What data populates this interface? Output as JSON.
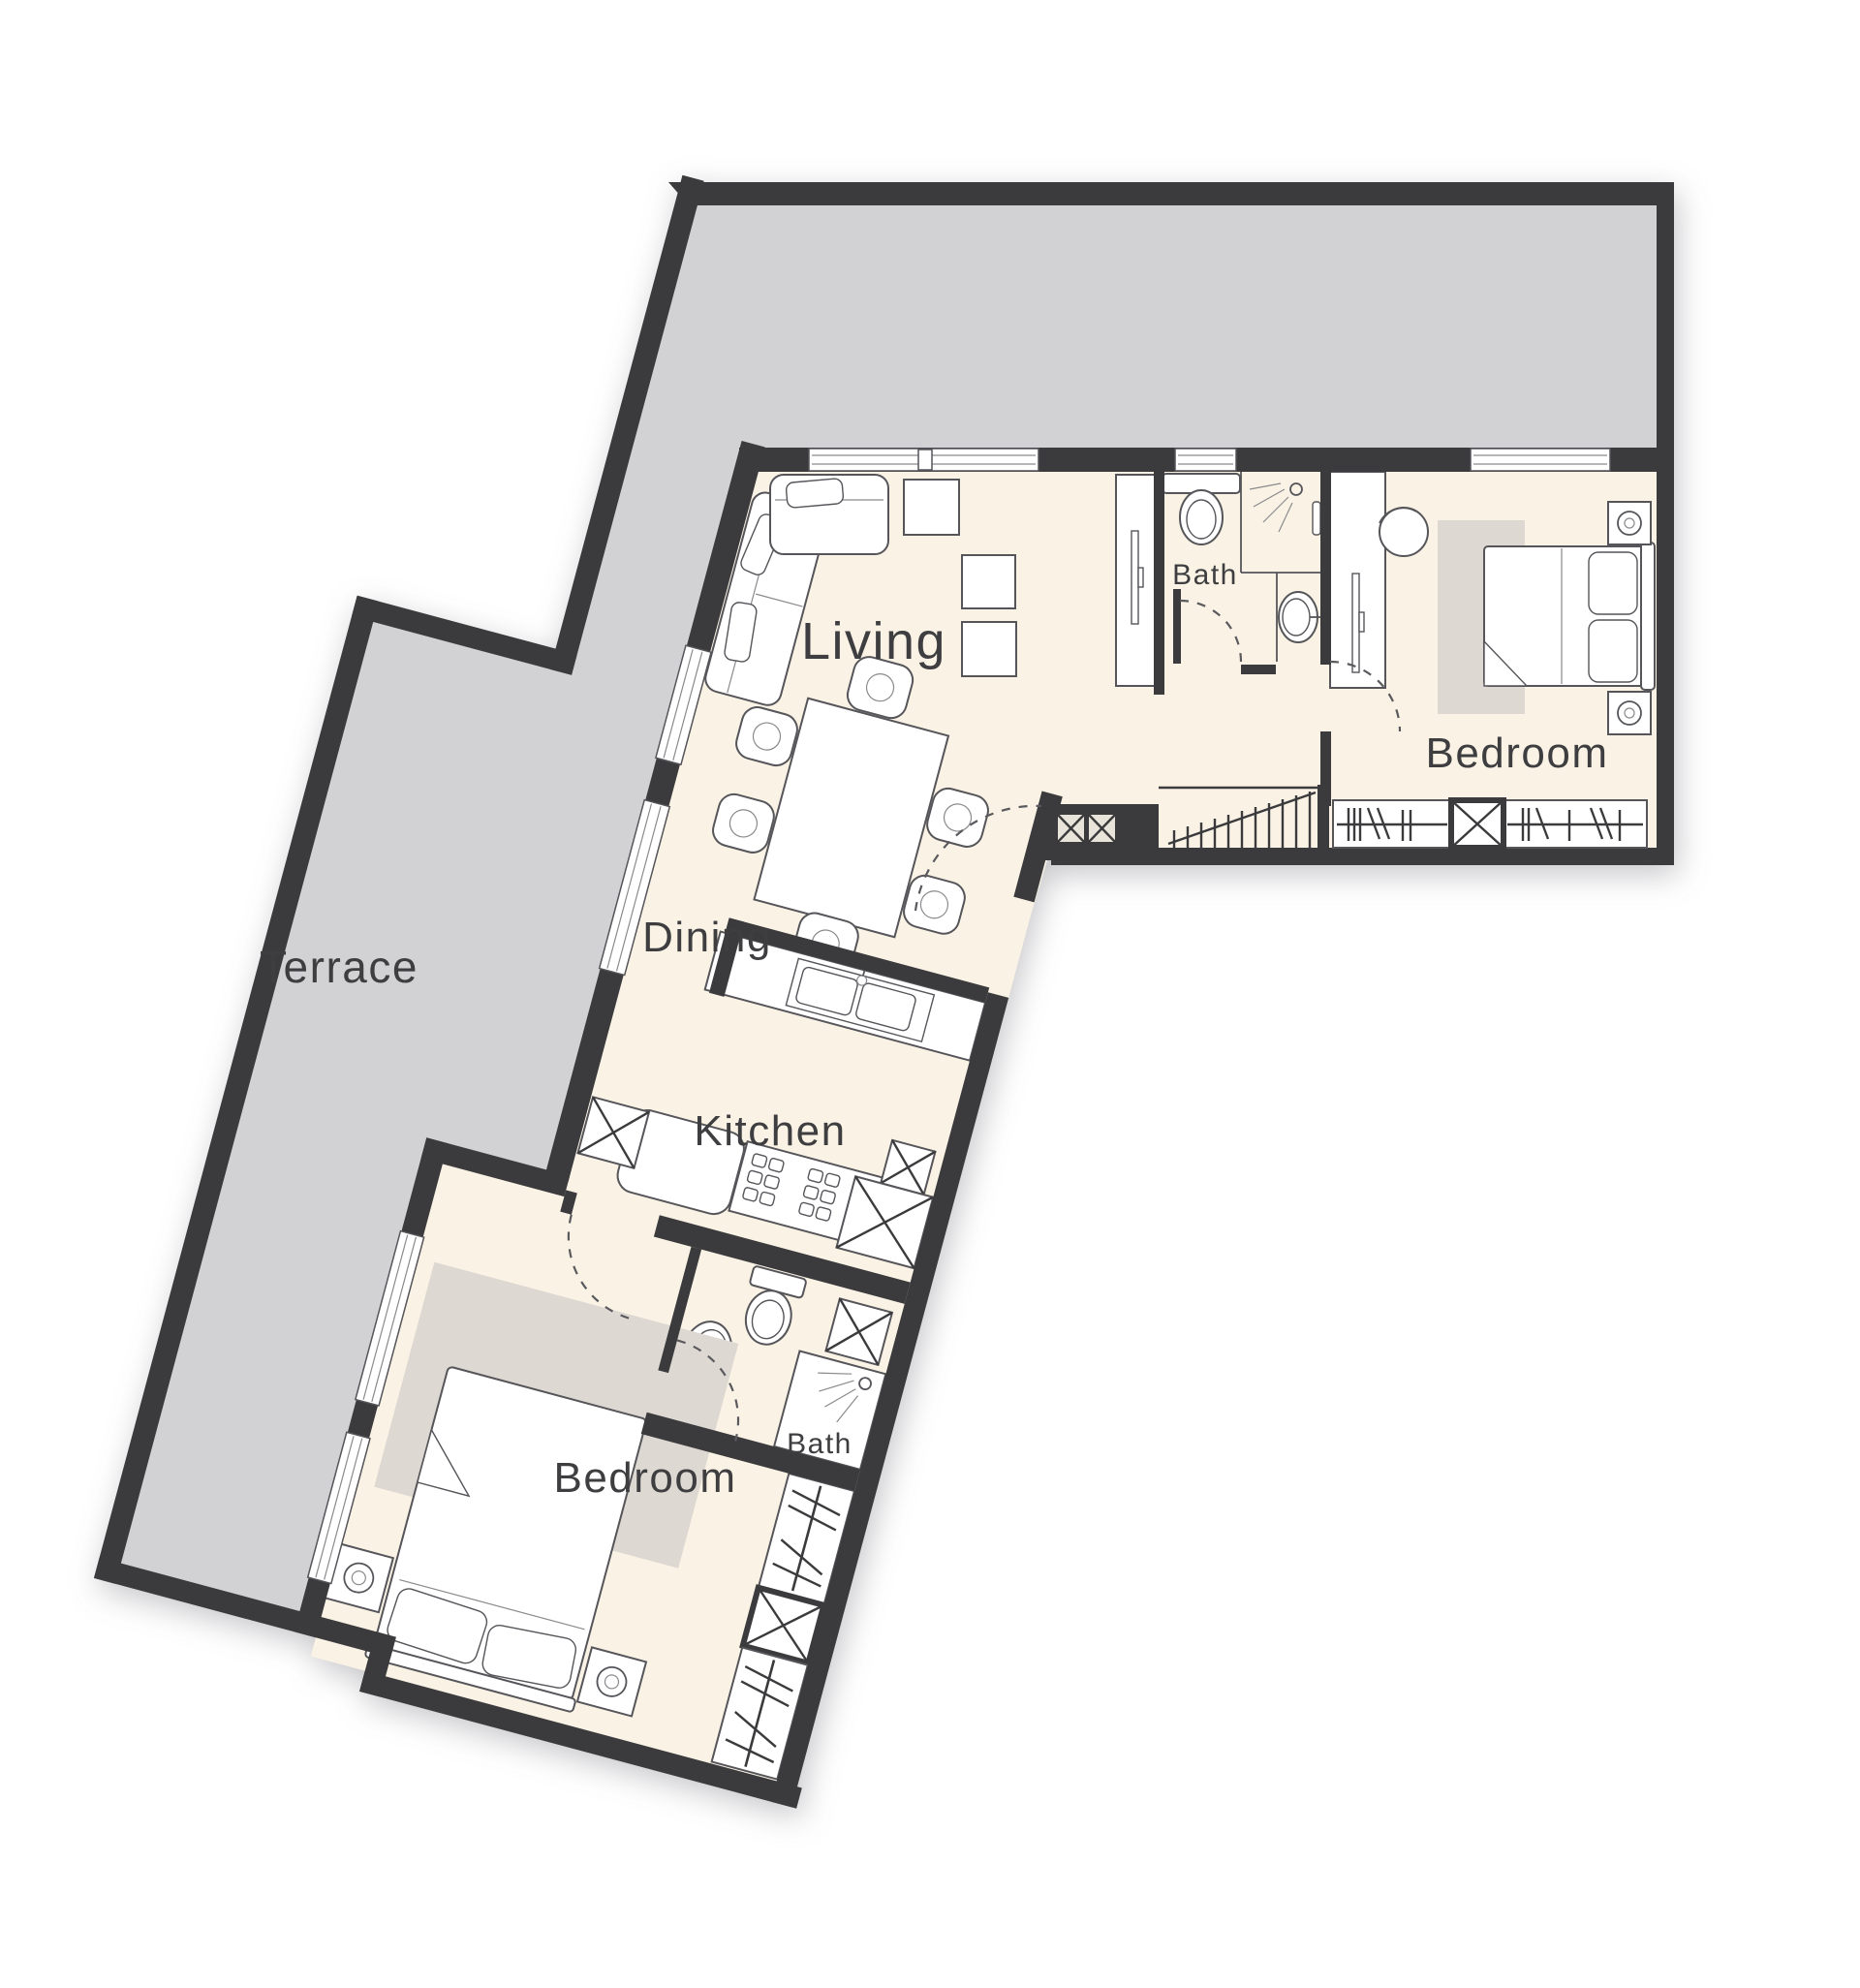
{
  "title": "Apartment floor plan",
  "rooms": {
    "terrace": {
      "label": "Terrace"
    },
    "living": {
      "label": "Living"
    },
    "dining": {
      "label": "Dining"
    },
    "kitchen": {
      "label": "Kitchen"
    },
    "bath_upper": {
      "label": "Bath"
    },
    "bedroom_upper": {
      "label": "Bedroom"
    },
    "bath_lower": {
      "label": "Bath"
    },
    "bedroom_lower": {
      "label": "Bedroom"
    }
  },
  "icons": {
    "shaft": "x-cross-box",
    "shower": "spray-head",
    "wardrobe": "hatched-strip",
    "door": "dashed-swing-arc",
    "stairs": "tread-lines-with-diagonal"
  },
  "colors": {
    "wall": "#3b3b3d",
    "terrace": "#d2d2d4",
    "floor": "#faf3e5",
    "rug": "#ded8d2",
    "line": "#55555a",
    "label": "#3e3e41",
    "bg": "#ffffff",
    "fixture": "#ffffff"
  }
}
